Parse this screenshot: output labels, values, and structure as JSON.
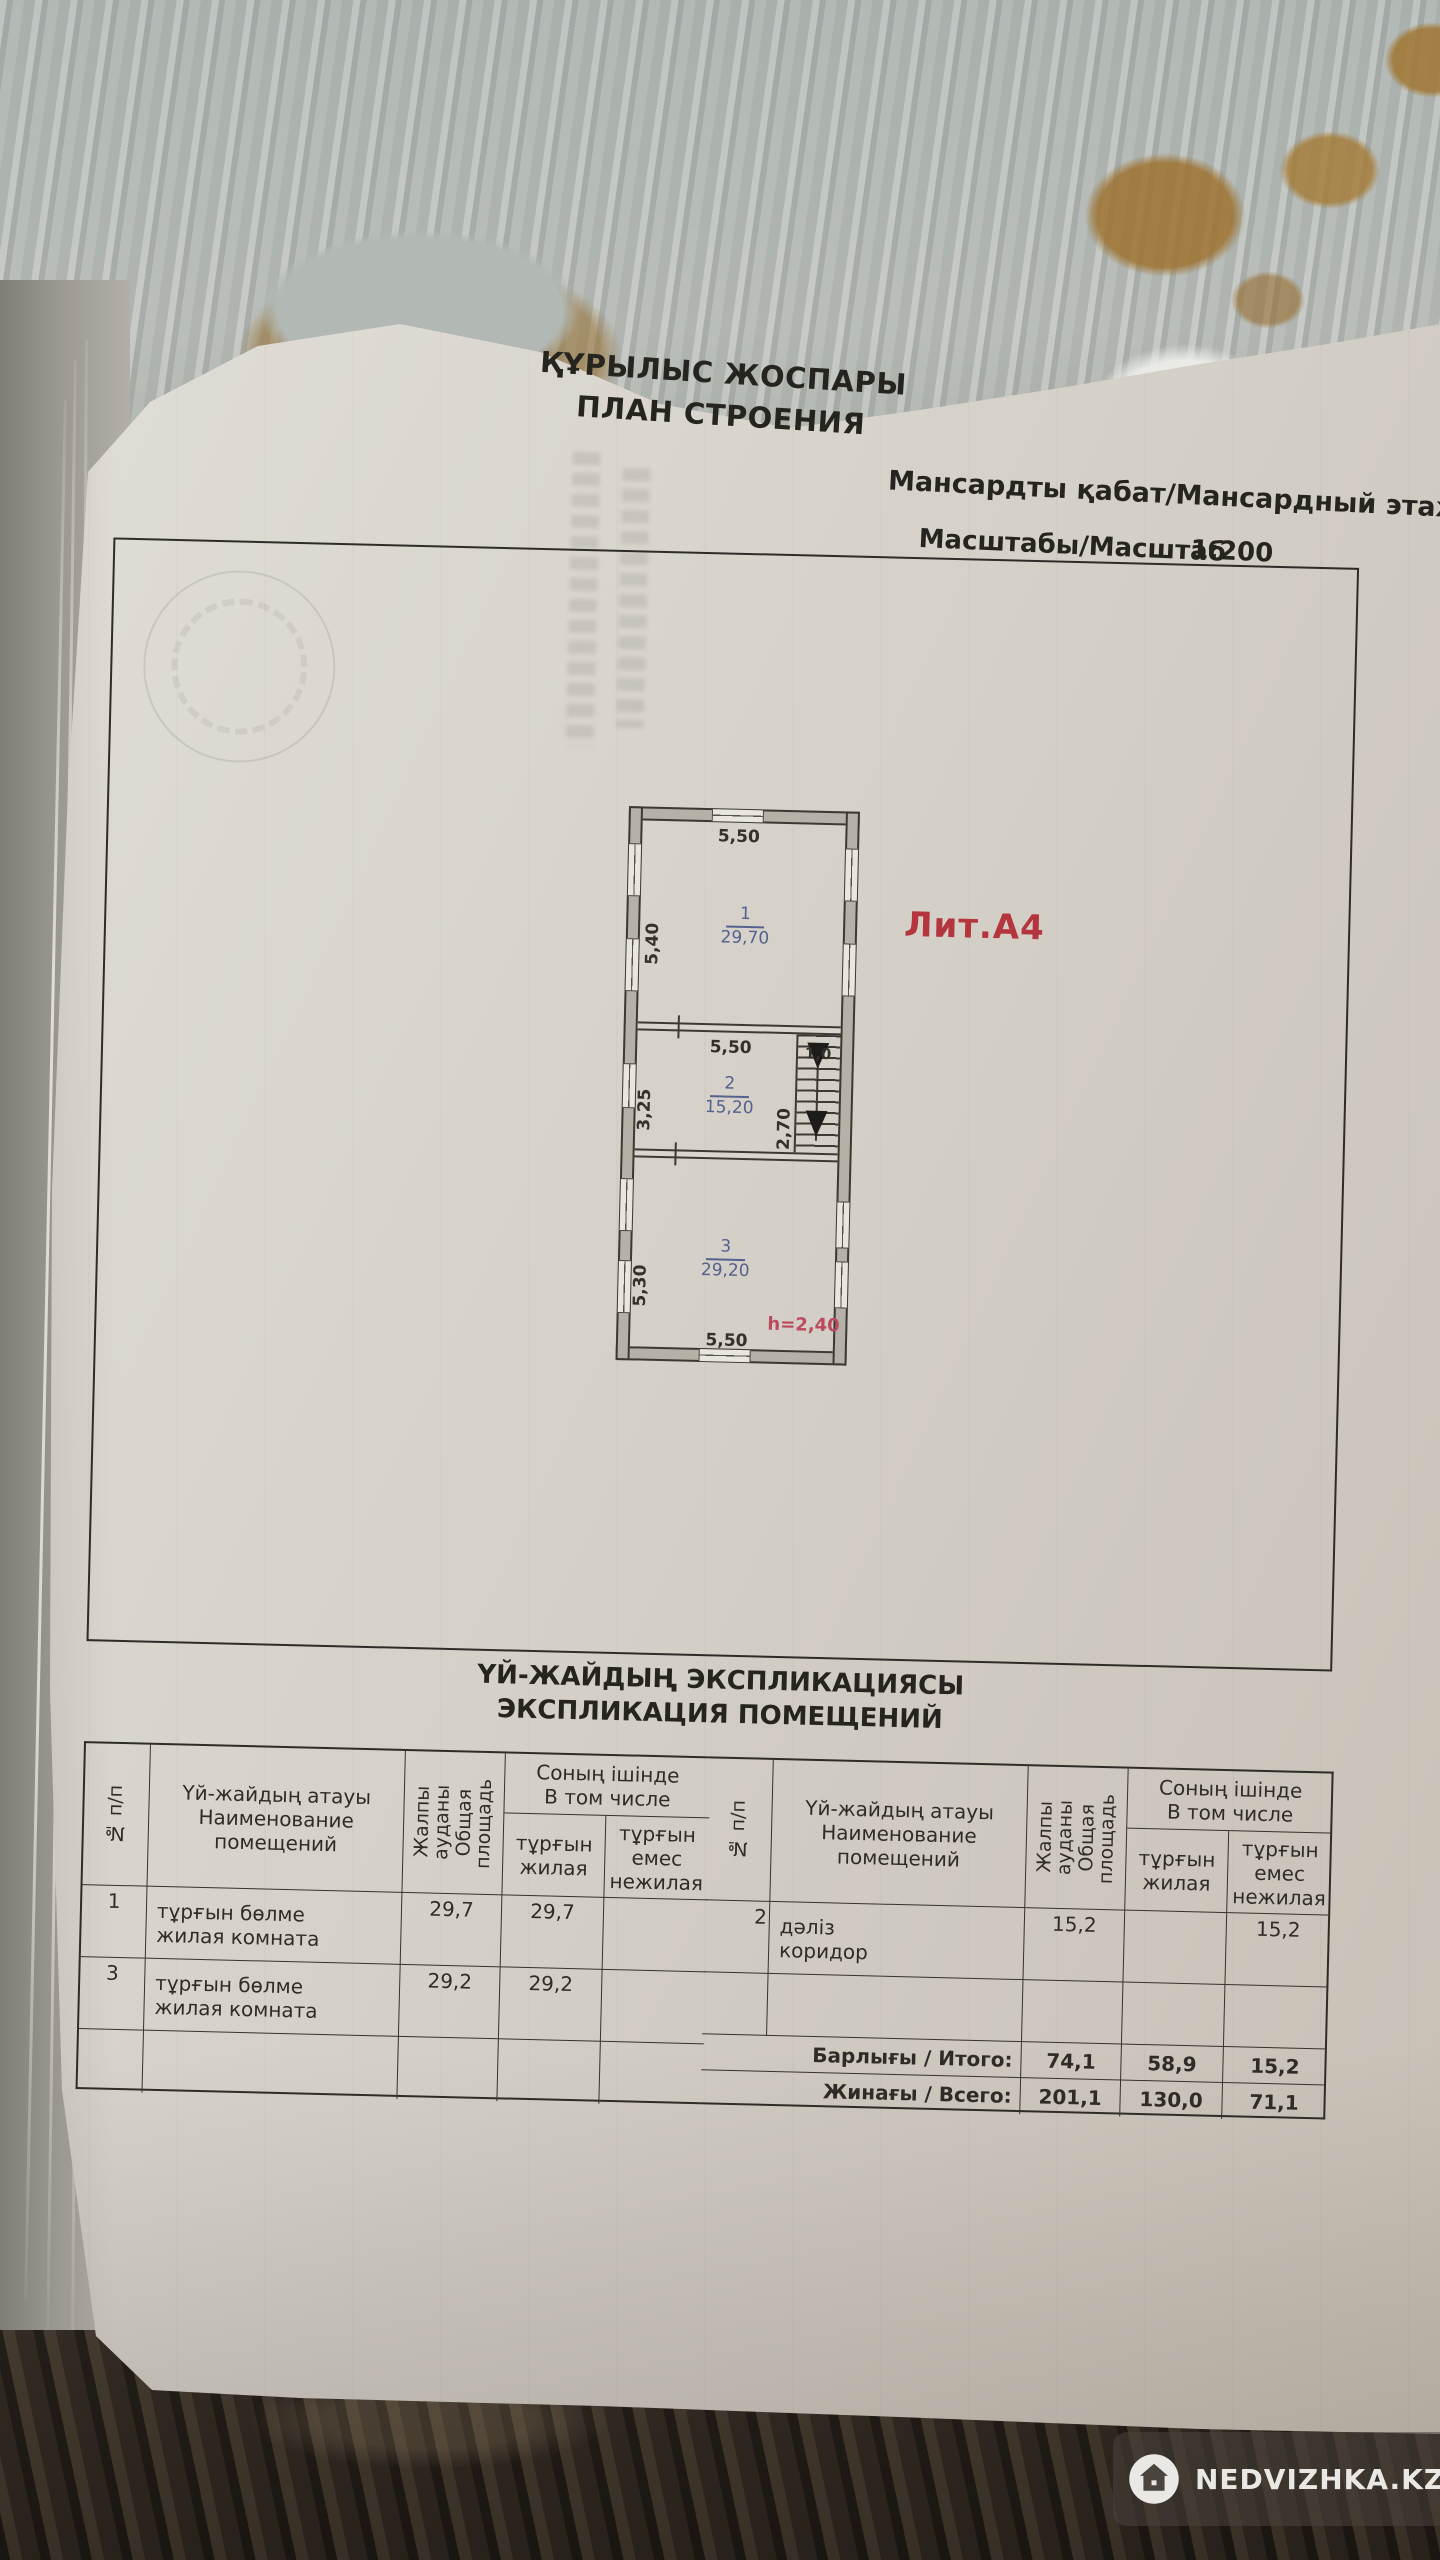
{
  "doc": {
    "title_kk": "ҚҰРЫЛЫС ЖОСПАРЫ",
    "title_ru": "ПЛАН СТРОЕНИЯ",
    "floor_label": "Мансардты қабат/Мансардный этаж",
    "scale_label": "Масштабы/Масштаб",
    "scale_value": "1:200"
  },
  "plan": {
    "liter": "Лит.А4",
    "height_note": "h=2,40",
    "rooms": [
      {
        "num": "1",
        "area": "29,70"
      },
      {
        "num": "2",
        "area": "15,20"
      },
      {
        "num": "3",
        "area": "29,20"
      }
    ],
    "dims": {
      "top": "5,50",
      "room1_left": "5,40",
      "room2_top": "5,50",
      "stair_top": "1,0",
      "room2_left": "3,25",
      "stair_side": "2,70",
      "room3_left": "5,30",
      "bottom": "5,50"
    }
  },
  "table": {
    "title_kk": "ҮЙ-ЖАЙДЫҢ ЭКСПЛИКАЦИЯСЫ",
    "title_ru": "ЭКСПЛИКАЦИЯ ПОМЕЩЕНИЙ",
    "headers": {
      "num": "№ п/п",
      "name_kk": "Үй-жайдың атауы",
      "name_ru": "Наименование помещений",
      "total_kk": "Жалпы ауданы",
      "total_ru": "Общая площадь",
      "including_kk": "Соның ішінде",
      "including_ru": "В том числе",
      "living_kk": "тұрғын",
      "living_ru": "жилая",
      "nonliving_kk": "тұрғын емес",
      "nonliving_ru": "нежилая"
    },
    "left_rows": [
      {
        "num": "1",
        "name_kk": "тұрғын бөлме",
        "name_ru": "жилая комната",
        "total": "29,7",
        "living": "29,7",
        "nonliving": ""
      },
      {
        "num": "3",
        "name_kk": "тұрғын бөлме",
        "name_ru": "жилая комната",
        "total": "29,2",
        "living": "29,2",
        "nonliving": ""
      }
    ],
    "right_rows": [
      {
        "num": "2",
        "name_kk": "дәліз",
        "name_ru": "коридор",
        "total": "15,2",
        "living": "",
        "nonliving": "15,2"
      }
    ],
    "totals": [
      {
        "label": "Барлығы / Итого:",
        "total": "74,1",
        "living": "58,9",
        "nonliving": "15,2"
      },
      {
        "label": "Жинағы / Всего:",
        "total": "201,1",
        "living": "130,0",
        "nonliving": "71,1"
      }
    ]
  },
  "watermark": {
    "text": "NEDVIZHKA.KZ"
  },
  "colors": {
    "liter_red": "#b5353f",
    "room_blue": "#55618f",
    "height_pink": "#bb4a5c",
    "paper": "#d6d2ca"
  }
}
